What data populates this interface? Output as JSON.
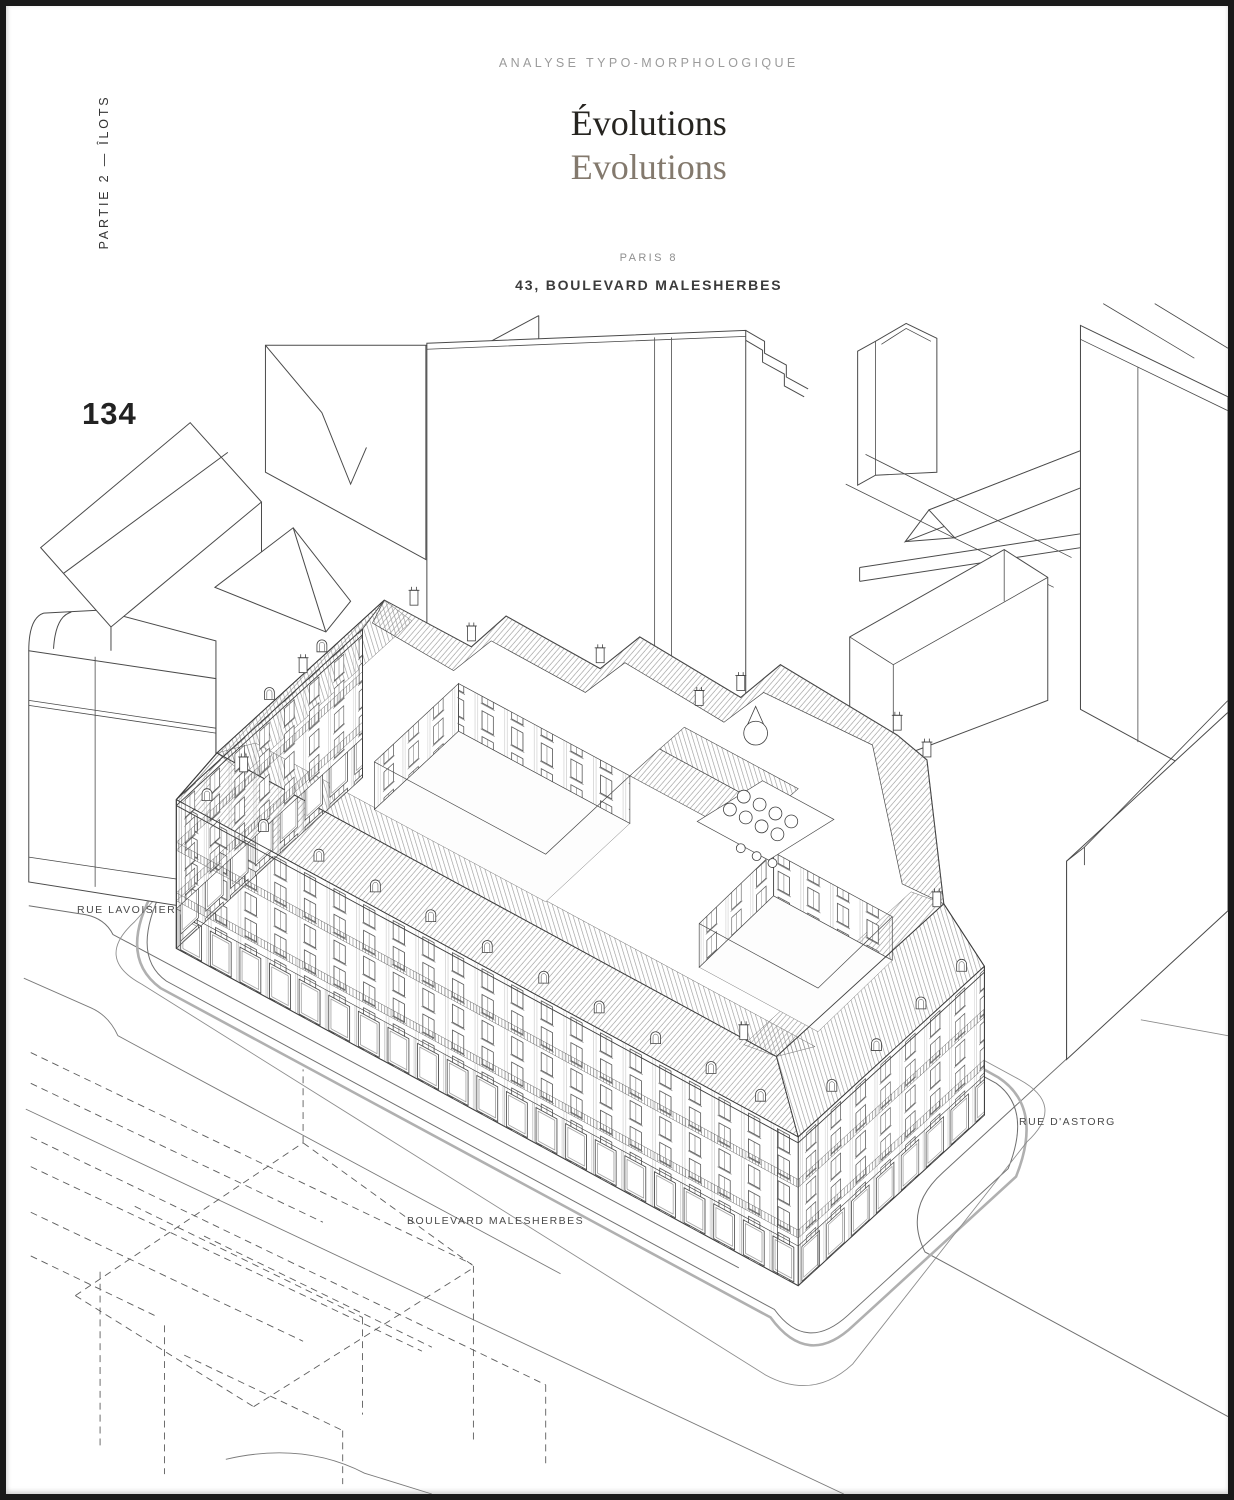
{
  "page": {
    "kicker": "ANALYSE TYPO-MORPHOLOGIQUE",
    "title_fr": "Évolutions",
    "title_en": "Evolutions",
    "district": "PARIS 8",
    "address": "43, BOULEVARD MALESHERBES",
    "side_label": "PARTIE 2 — ÎLOTS",
    "page_number": "134"
  },
  "drawing": {
    "type": "axonometric-line-drawing",
    "subject": "Urban block at 43, Boulevard Malesherbes, Paris 8",
    "streets": {
      "lavoisier": "RUE LAVOISIER",
      "malesherbes": "BOULEVARD MALESHERBES",
      "astorg": "RUE D'ASTORG"
    }
  },
  "colors": {
    "title_fr": "#262420",
    "title_en": "#83796d",
    "kicker": "#9b9b9b",
    "ink": "#3e3e3e",
    "hatch": "#8b8b8b",
    "curb_gray": "#b0b0b0",
    "frame": "#191919"
  }
}
